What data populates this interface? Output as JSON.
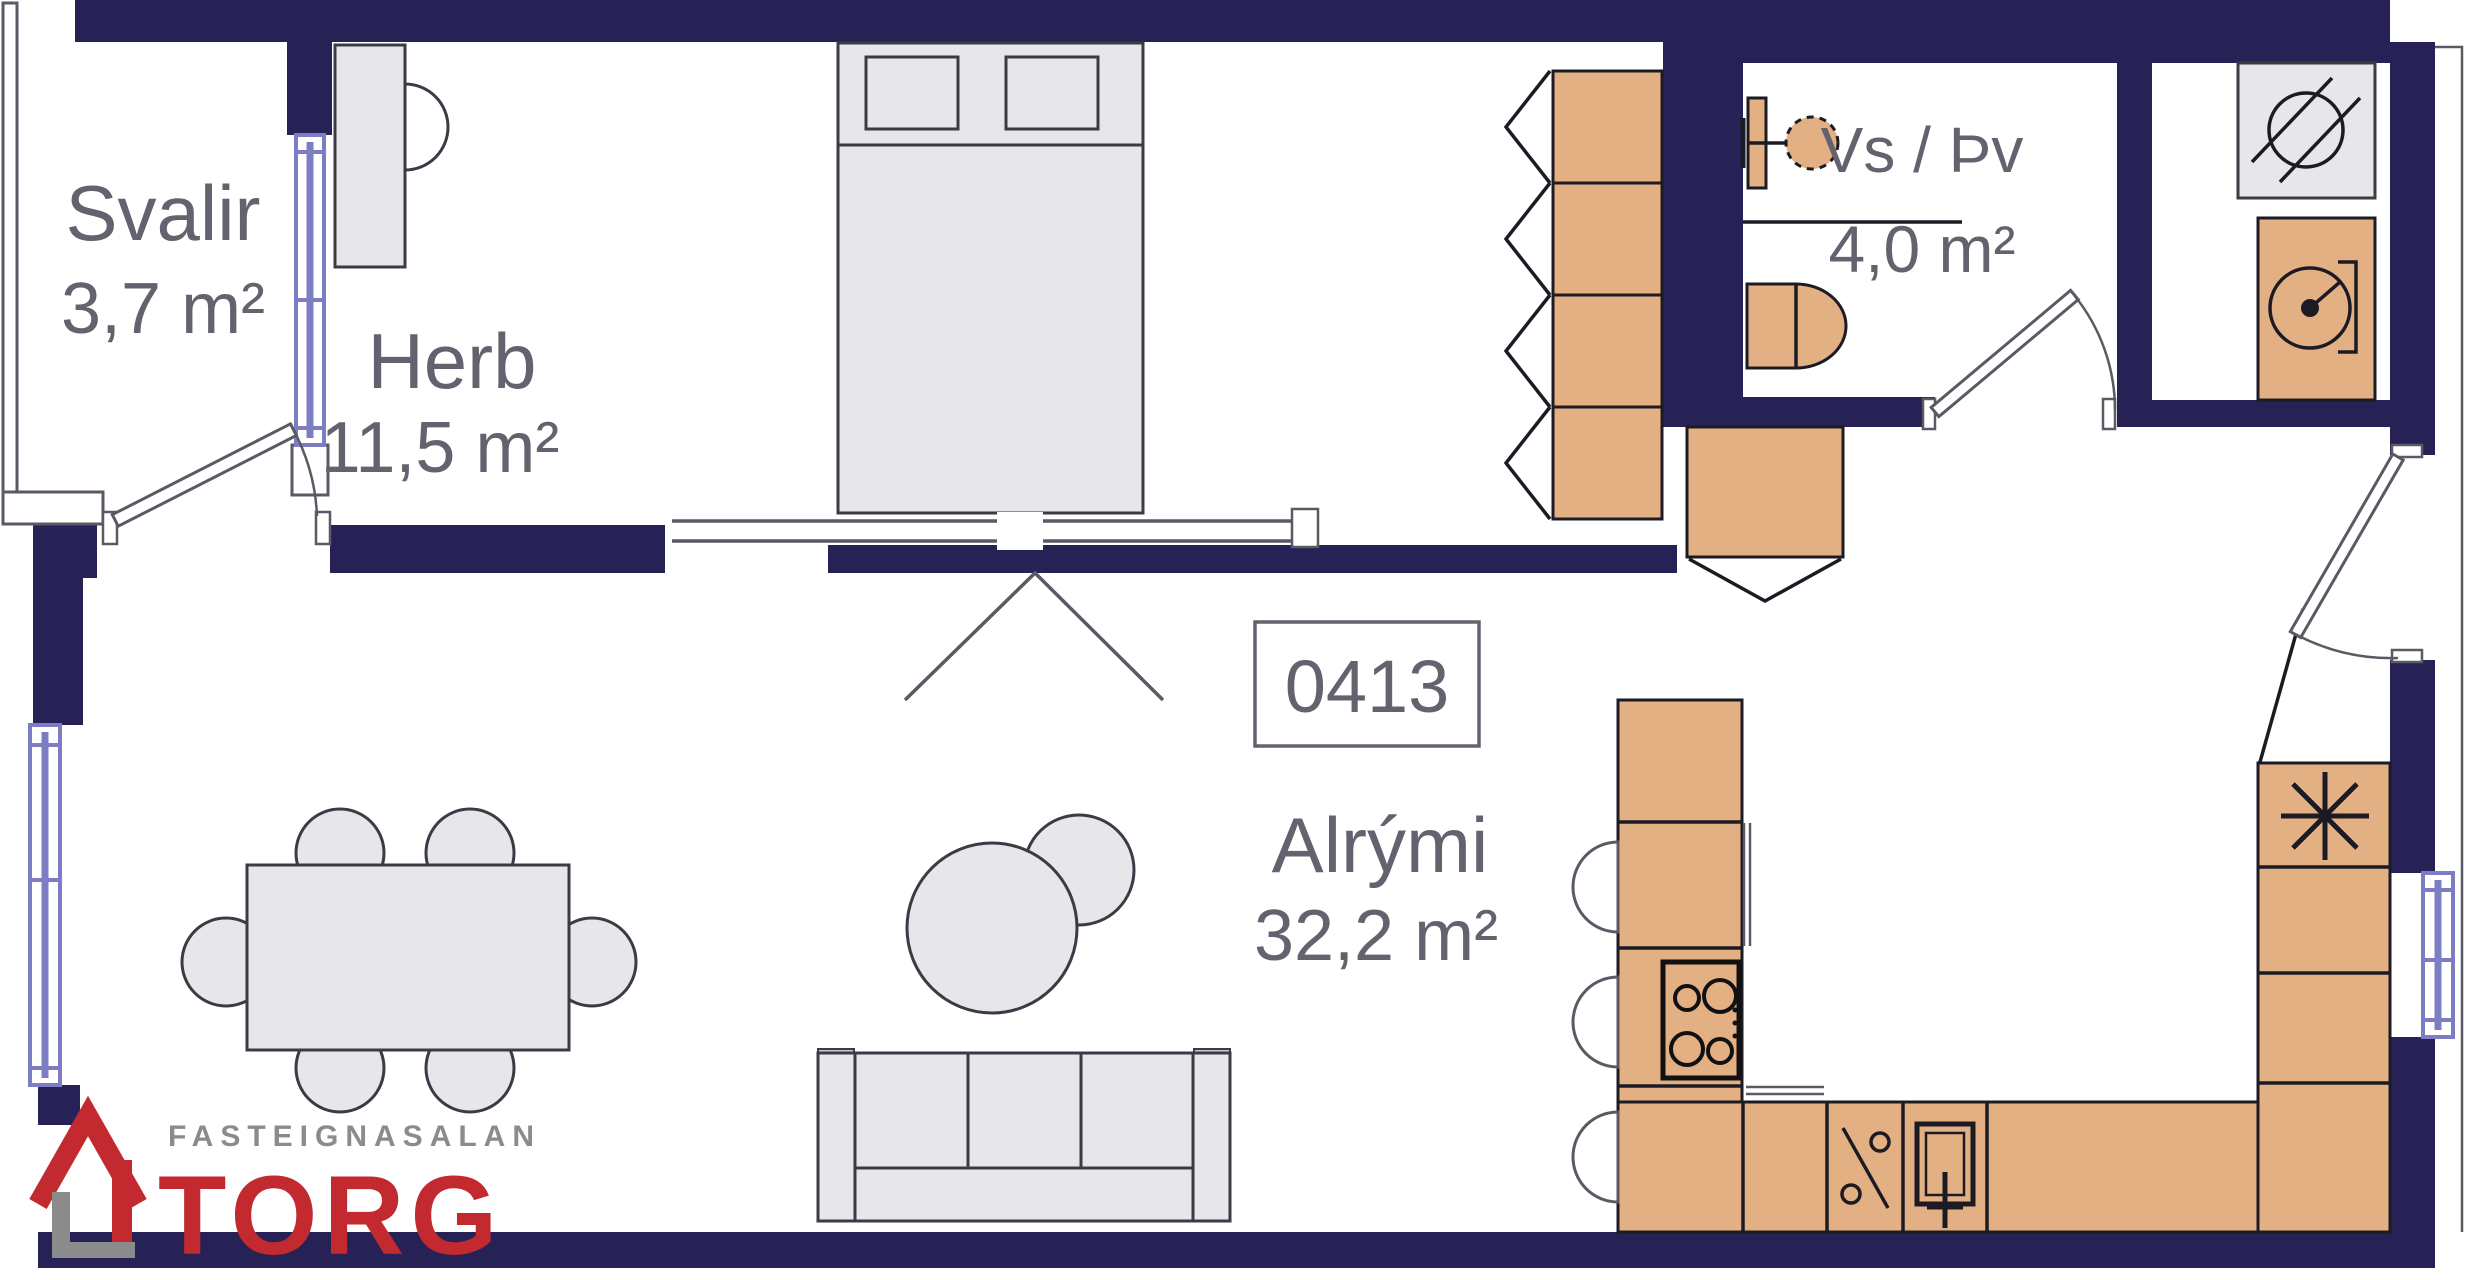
{
  "unit": {
    "number": "0413"
  },
  "rooms": [
    {
      "id": "svalir",
      "name": "Svalir",
      "area": "3,7 m²"
    },
    {
      "id": "herb",
      "name": "Herb",
      "area": "11,5 m²"
    },
    {
      "id": "vs-thv",
      "name": "Vs / Þv",
      "area": "4,0 m²"
    },
    {
      "id": "alrymi",
      "name": "Alrými",
      "area": "32,2 m²"
    }
  ],
  "logo": {
    "tagline": "FASTEIGNASALAN",
    "brand": "TORG"
  },
  "colors": {
    "wall_navy": "#272256",
    "window_blue": "#7d7dc3",
    "cabinet_tan": "#e3b083",
    "furniture_gray": "#e7e7e9",
    "outline_dark": "#1c1b24",
    "line_gray": "#5a5964",
    "text_gray": "#63626e",
    "logo_red": "#c22a30",
    "logo_gray": "#8b8b8b",
    "background": "#ffffff"
  },
  "icons": {
    "shower-drain-icon": "circle with two diagonal strokes",
    "freezer-asterisk-icon": "eight-ray asterisk",
    "washer-drum-icon": "drum circle with hub dot and bracket",
    "stove-burners-icon": "four burner circles",
    "dishwasher-icon": "diagonal line with two small circles",
    "kitchen-sink-icon": "double square with faucet cross",
    "bath-sink-icon": "dashed circle with wall tap",
    "door-swing-arc": "quarter-circle door swing",
    "window-symbol": "double blue line",
    "sliding-door-symbol": "double rail with panel break",
    "logo-house-icon": "red roof house with gray base"
  }
}
